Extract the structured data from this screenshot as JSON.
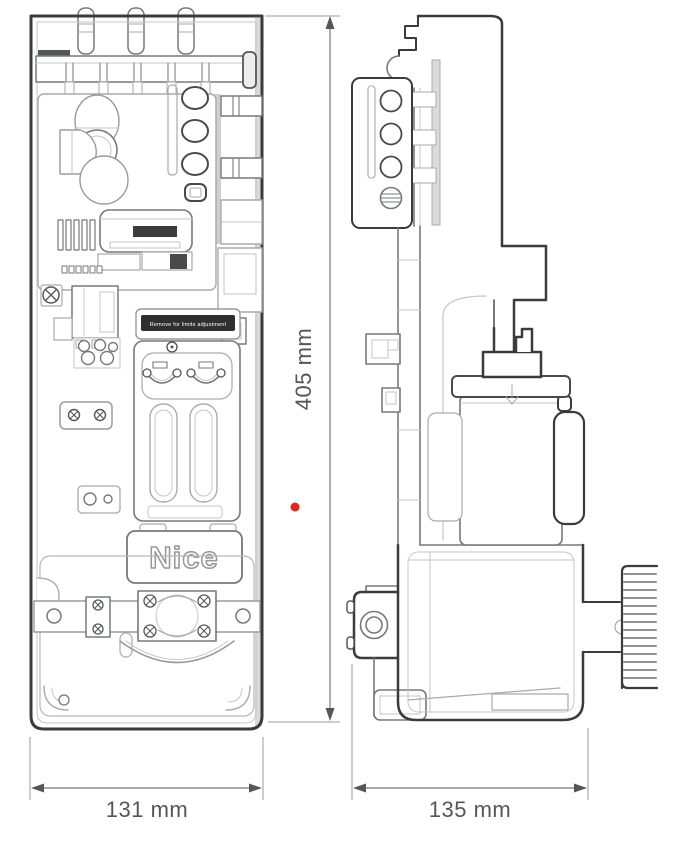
{
  "figure": {
    "dimensions": {
      "height": "405 mm",
      "front_width": "131 mm",
      "side_width": "135 mm"
    },
    "brand_label": "Nice",
    "warning_label": "Remove for limits adjustment",
    "colors": {
      "outline_dark": "#3b3b3d",
      "outline_medium": "#77787b",
      "outline_light": "#a9aaac",
      "dimension_gray": "#55565a",
      "marker_red": "#e5231f",
      "background": "#ffffff"
    },
    "marker": {
      "x": 295,
      "y": 507
    }
  }
}
